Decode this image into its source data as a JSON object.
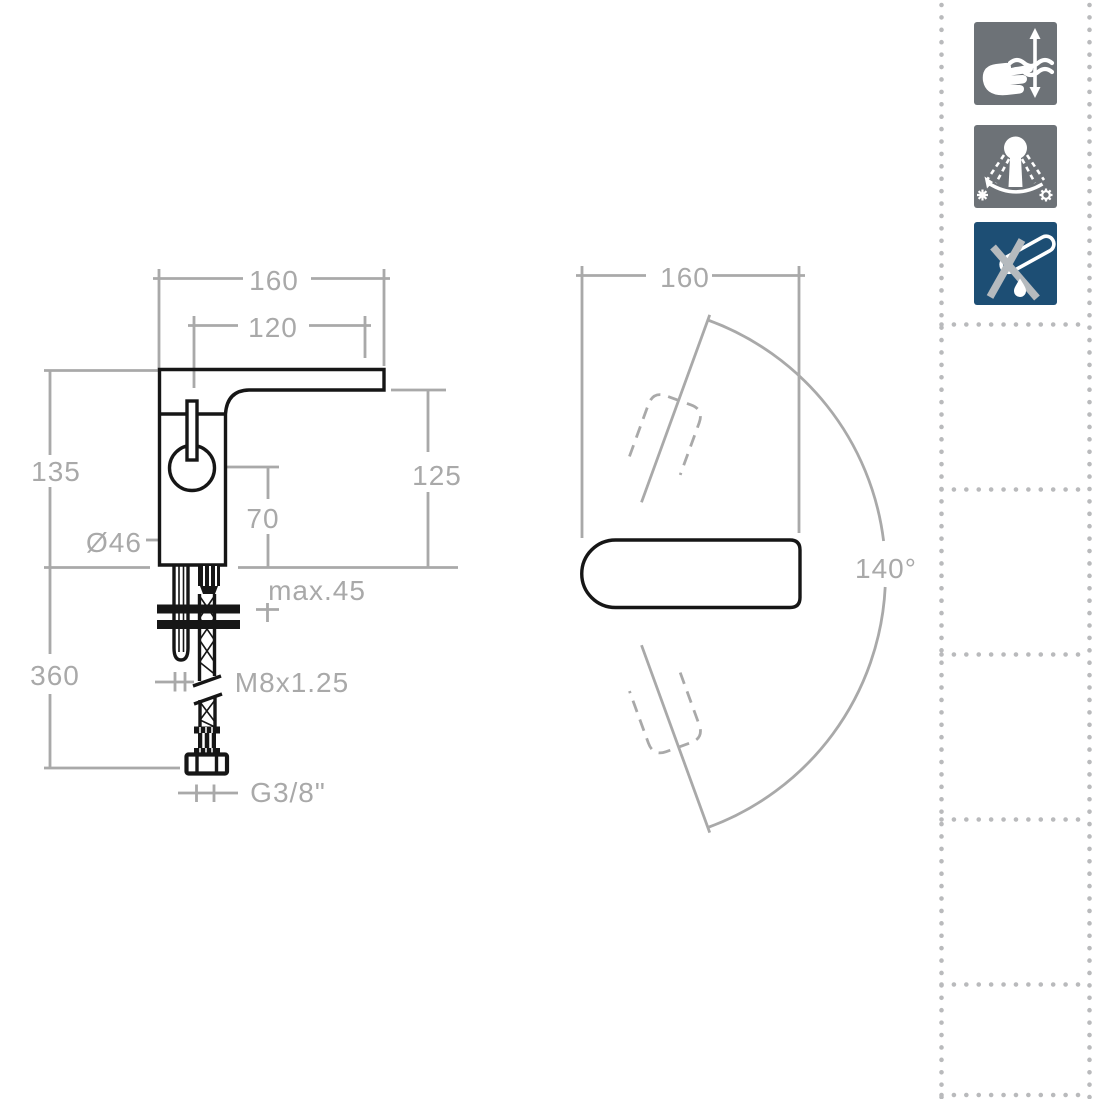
{
  "side_view": {
    "labels": {
      "total_width": "160",
      "spout_width": "120",
      "body_height": "135",
      "spout_height": "125",
      "axis_height": "70",
      "body_diameter": "Ø46",
      "deck_thickness": "max.45",
      "under_counter_length": "360",
      "stud_thread": "M8x1.25",
      "hose_thread": "G3/8\""
    }
  },
  "top_view": {
    "labels": {
      "total_width": "160",
      "swivel_angle": "140°"
    }
  },
  "icons": [
    {
      "id": "flow-adjustment",
      "bg": "#6d7277",
      "fg": "#ffffff",
      "description": "hand adjusting flow with up-down arrow"
    },
    {
      "id": "swivel-cold-range",
      "bg": "#6d7277",
      "fg": "#ffffff",
      "description": "lever arc between cold symbols"
    },
    {
      "id": "no-pop-up-waste",
      "bg": "#1d4e74",
      "fg": "#ffffff",
      "cross": "#b5babe",
      "description": "waste pipe crossed out with drop"
    }
  ],
  "colors": {
    "line_black": "#161616",
    "dim_gray": "#a9a9a9",
    "dot_gray": "#b9babc"
  }
}
